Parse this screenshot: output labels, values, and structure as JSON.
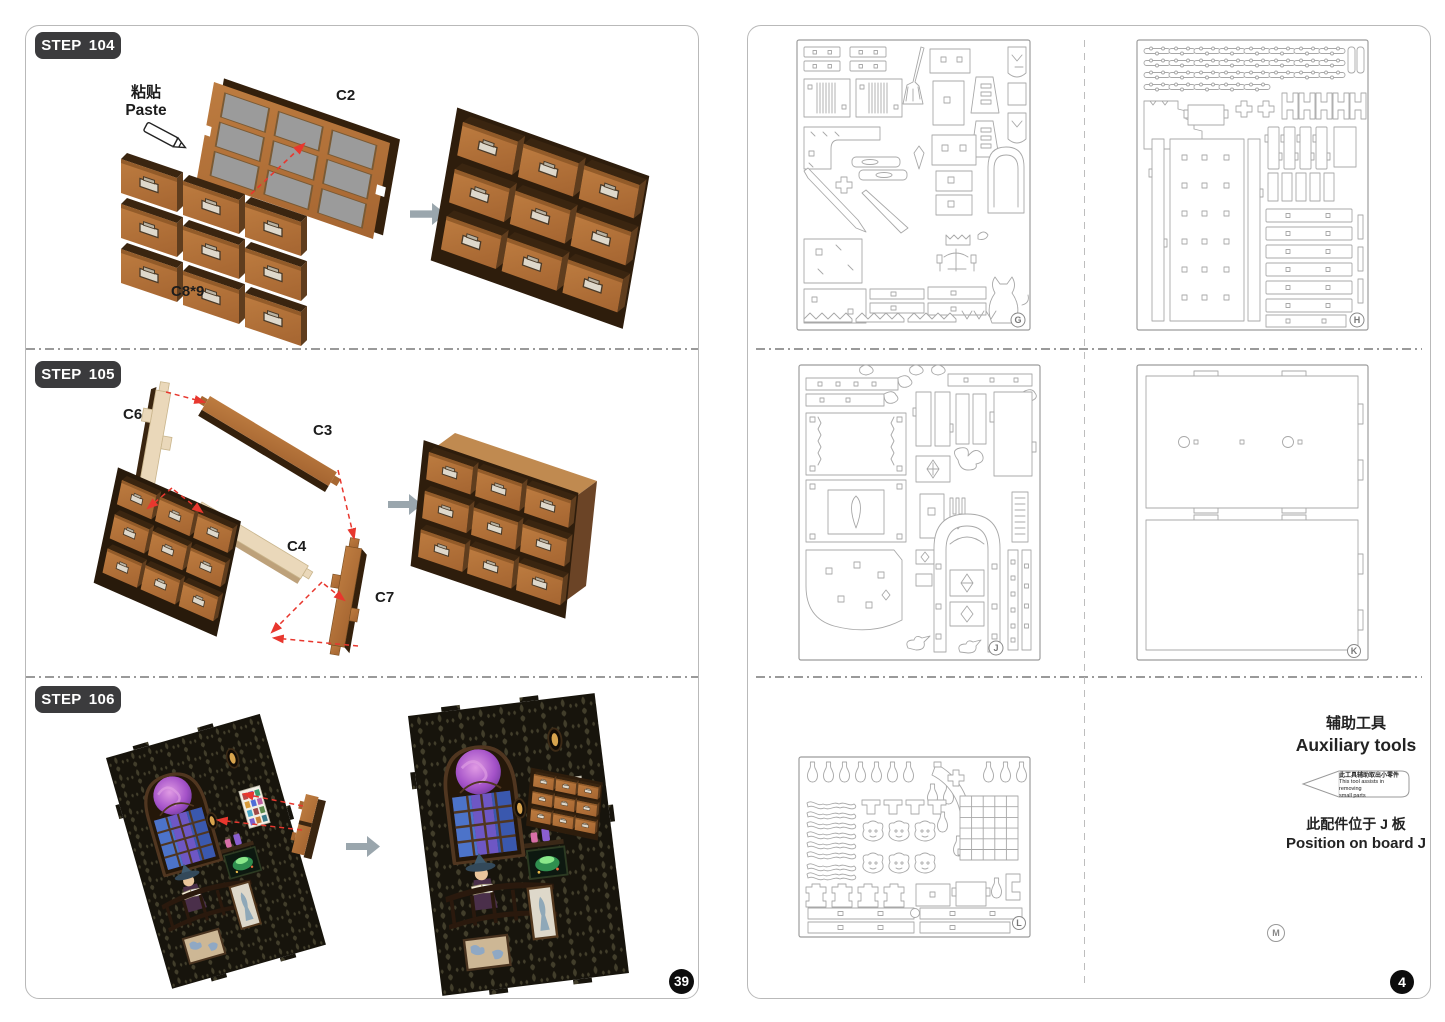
{
  "left_page": {
    "page_number": "39",
    "steps": [
      {
        "label": "STEP 104",
        "paste_zh": "粘贴",
        "paste_en": "Paste",
        "part_labels": {
          "frame": "C2",
          "drawers": "C8*9"
        }
      },
      {
        "label": "STEP 105",
        "part_labels": {
          "c6": "C6",
          "c3": "C3",
          "c4": "C4",
          "c7": "C7"
        }
      },
      {
        "label": "STEP 106"
      }
    ]
  },
  "right_page": {
    "page_number": "4",
    "board_letters": {
      "g": "G",
      "h": "H",
      "j": "J",
      "k": "K",
      "l": "L",
      "m": "M"
    },
    "auxiliary": {
      "title_zh": "辅助工具",
      "title_en": "Auxiliary tools",
      "tool_note_zh": "此工具辅助取出小零件",
      "tool_note_en_1": "This tool assists in removing",
      "tool_note_en_2": "small parts",
      "position_zh": "此配件位于 J 板",
      "position_en": "Position on board J"
    }
  },
  "colors": {
    "wood": "#b5743a",
    "wood_dark": "#3a2510",
    "cream": "#ead8ba",
    "glue_arrow_red": "#e8372e",
    "step_arrow_gray": "#9aa6ad",
    "badge_bg": "#3b3b3d"
  }
}
